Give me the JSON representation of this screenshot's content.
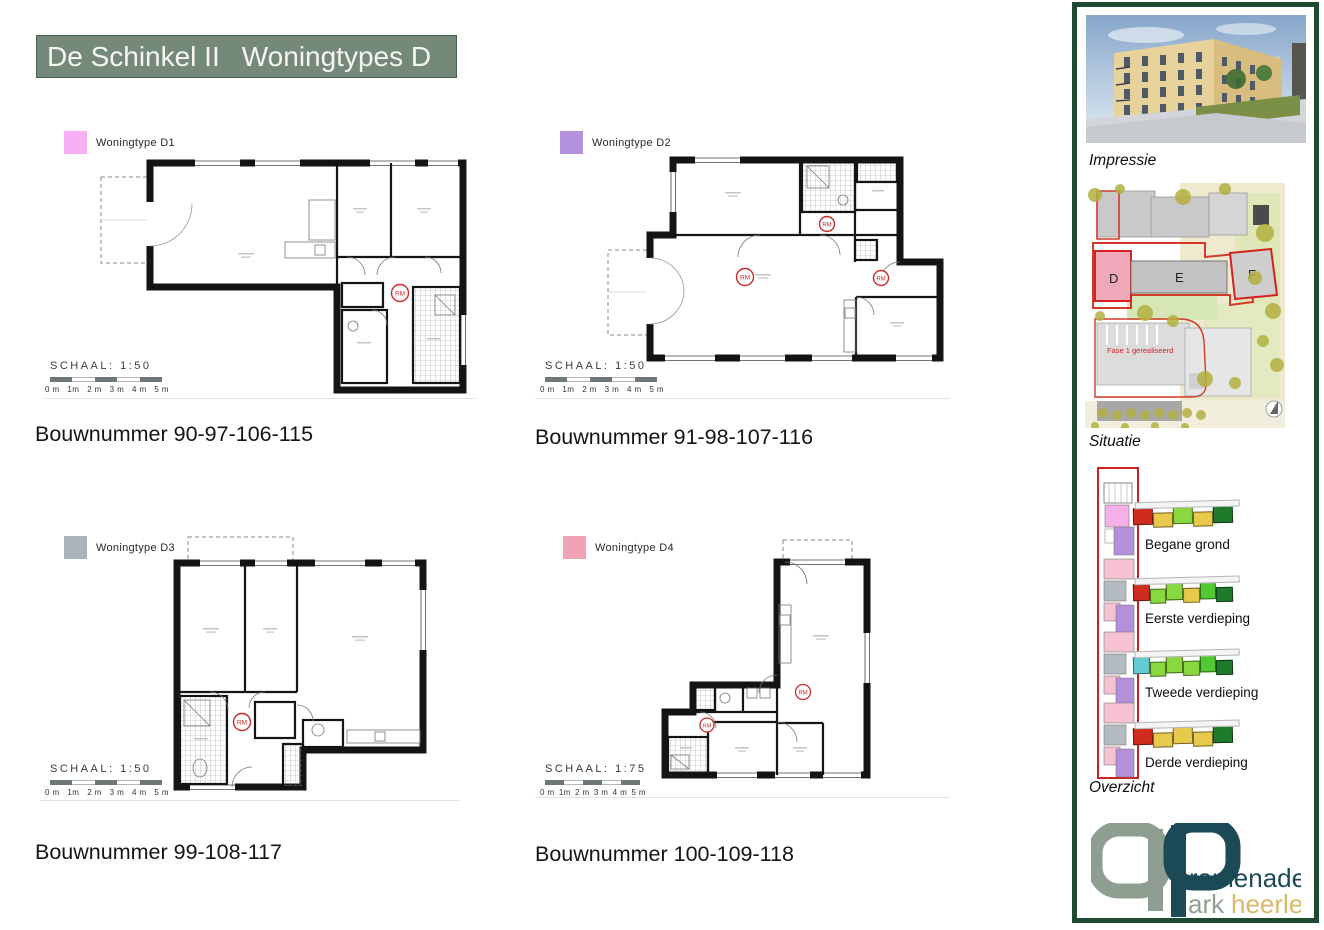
{
  "title": {
    "left": "De Schinkel II",
    "right": "Woningtypes D"
  },
  "scale_ticks": [
    "0 m",
    "1m",
    "2 m",
    "3 m",
    "4 m",
    "5 m"
  ],
  "rm_label": "RM",
  "plans": [
    {
      "legend_label": "Woningtype D1",
      "legend_color": "#f7aef2",
      "schaal_label": "SCHAAL:  1:50",
      "bouwnummer": "Bouwnummer 90-97-106-115"
    },
    {
      "legend_label": "Woningtype D2",
      "legend_color": "#b491dd",
      "schaal_label": "SCHAAL:  1:50",
      "bouwnummer": "Bouwnummer 91-98-107-116"
    },
    {
      "legend_label": "Woningtype D3",
      "legend_color": "#aab3b9",
      "schaal_label": "SCHAAL:  1:50",
      "bouwnummer": "Bouwnummer 99-108-117"
    },
    {
      "legend_label": "Woningtype D4",
      "legend_color": "#f1a3b5",
      "schaal_label": "SCHAAL:  1:75",
      "bouwnummer": "Bouwnummer 100-109-118"
    }
  ],
  "sidebar": {
    "impressie_label": "Impressie",
    "situatie_label": "Situatie",
    "overzicht_label": "Overzicht",
    "situatie": {
      "block_d": "D",
      "block_e": "E",
      "block_f": "F",
      "fase_text": "Fase 1 gerealiseerd"
    },
    "floors": [
      {
        "label": "Begane grond",
        "colors": [
          "#cf2b1f",
          "#e7c94c",
          "#8ad83f",
          "#e7c94c",
          "#1f7a2a"
        ]
      },
      {
        "label": "Eerste verdieping",
        "colors": [
          "#cf2b1f",
          "#8ad83f",
          "#8ad83f",
          "#e7c94c",
          "#52c832",
          "#1f7a2a"
        ]
      },
      {
        "label": "Tweede verdieping",
        "colors": [
          "#63cbd2",
          "#8ad83f",
          "#8ad83f",
          "#8ad83f",
          "#52c832",
          "#1f7a2a"
        ]
      },
      {
        "label": "Derde verdieping",
        "colors": [
          "#cf2b1f",
          "#e7c94c",
          "#e7c94c",
          "#e7c94c",
          "#1f7a2a"
        ]
      }
    ],
    "logo": {
      "p1": "romenade",
      "p2": "ark",
      "p3": "heerlen"
    }
  },
  "colors": {
    "title_bg": "#75897b",
    "sidebar_border": "#1e4a31",
    "red_accent": "#cc2222",
    "logo_teal": "#1c4956",
    "logo_gray": "#8e9e90",
    "logo_gold": "#d8b96a"
  }
}
